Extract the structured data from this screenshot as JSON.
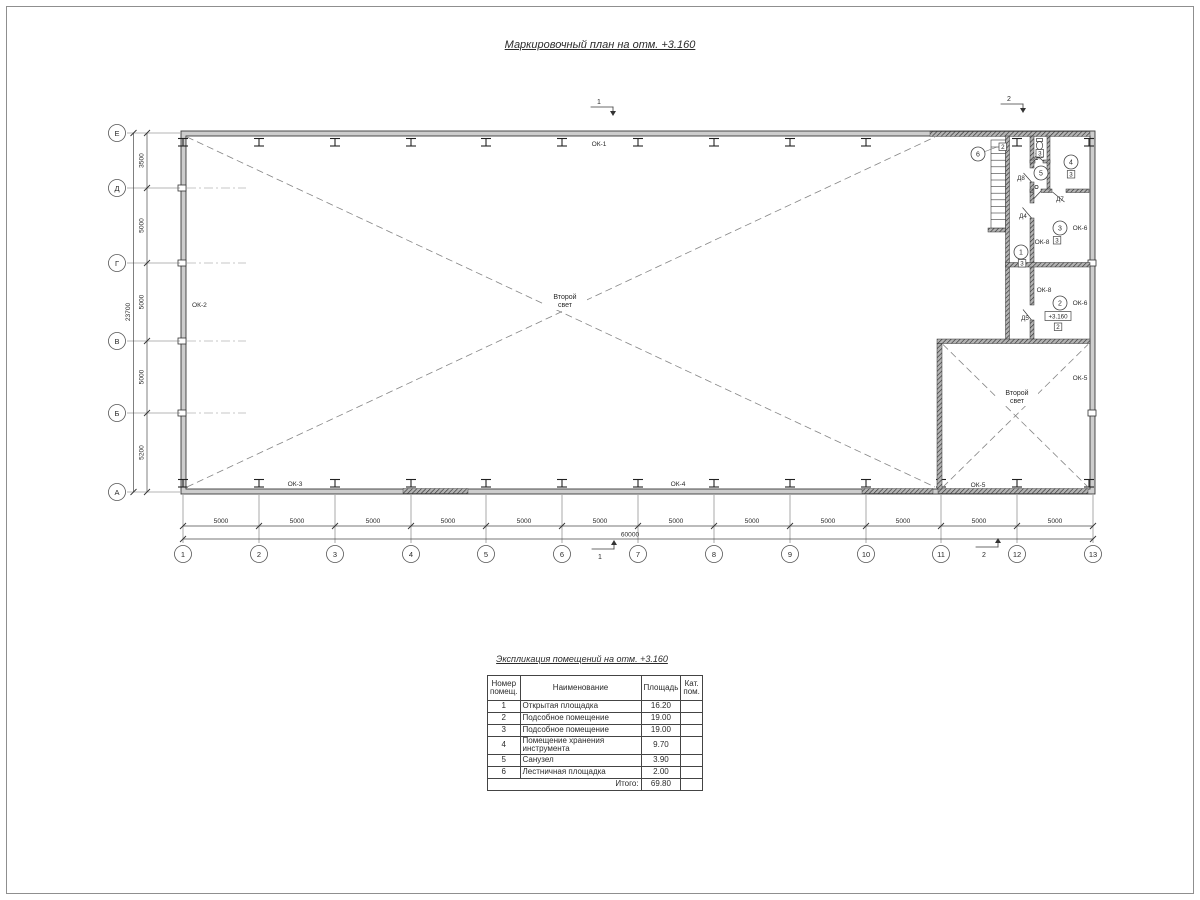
{
  "sheet": {
    "plan_title": "Маркировочный план на отм. +3.160",
    "table_title": "Экспликация помещений на отм. +3.160"
  },
  "plan": {
    "axis_letters": [
      "Е",
      "Д",
      "Г",
      "В",
      "Б",
      "А"
    ],
    "axis_numbers": [
      "1",
      "2",
      "3",
      "4",
      "5",
      "6",
      "7",
      "8",
      "9",
      "10",
      "11",
      "12",
      "13"
    ],
    "bay_dim": "5000",
    "total_width_dim": "60000",
    "v_dims": [
      "3500",
      "5000",
      "5000",
      "5000",
      "5200"
    ],
    "total_height_dim": "23700",
    "section_mark_1": "1",
    "section_mark_2": "2",
    "second_light_line1": "Второй",
    "second_light_line2": "свет",
    "elevation_mark": "+3.160",
    "windows": {
      "ok1": "ОК-1",
      "ok2": "ОК-2",
      "ok3": "ОК-3",
      "ok4": "ОК-4",
      "ok5": "ОК-5",
      "ok6": "ОК-6",
      "ok8": "ОК-8"
    },
    "doors": {
      "d4": "Д4",
      "d5": "Д5",
      "d7": "Д7",
      "d8": "Д8"
    },
    "rooms": {
      "r1": {
        "num": "1",
        "tag": "3"
      },
      "r2": {
        "num": "2",
        "tag": "2"
      },
      "r3": {
        "num": "3",
        "tag": "3"
      },
      "r4": {
        "num": "4",
        "tag": "3"
      },
      "r5": {
        "num": "5",
        "tag": "3"
      },
      "r6": {
        "num": "6",
        "tag": "2"
      }
    }
  },
  "table": {
    "headers": {
      "num": "Номер помещ.",
      "name": "Наименование",
      "area": "Площадь",
      "cat": "Кат. пом."
    },
    "rows": [
      {
        "num": "1",
        "name": "Открытая площадка",
        "area": "16.20",
        "cat": ""
      },
      {
        "num": "2",
        "name": "Подсобное помещение",
        "area": "19.00",
        "cat": ""
      },
      {
        "num": "3",
        "name": "Подсобное помещение",
        "area": "19.00",
        "cat": ""
      },
      {
        "num": "4",
        "name": "Помещение хранения инструмента",
        "area": "9.70",
        "cat": ""
      },
      {
        "num": "5",
        "name": "Санузел",
        "area": "3.90",
        "cat": ""
      },
      {
        "num": "6",
        "name": "Лестничная площадка",
        "area": "2.00",
        "cat": ""
      }
    ],
    "total_label": "Итого:",
    "total_value": "69.80"
  }
}
